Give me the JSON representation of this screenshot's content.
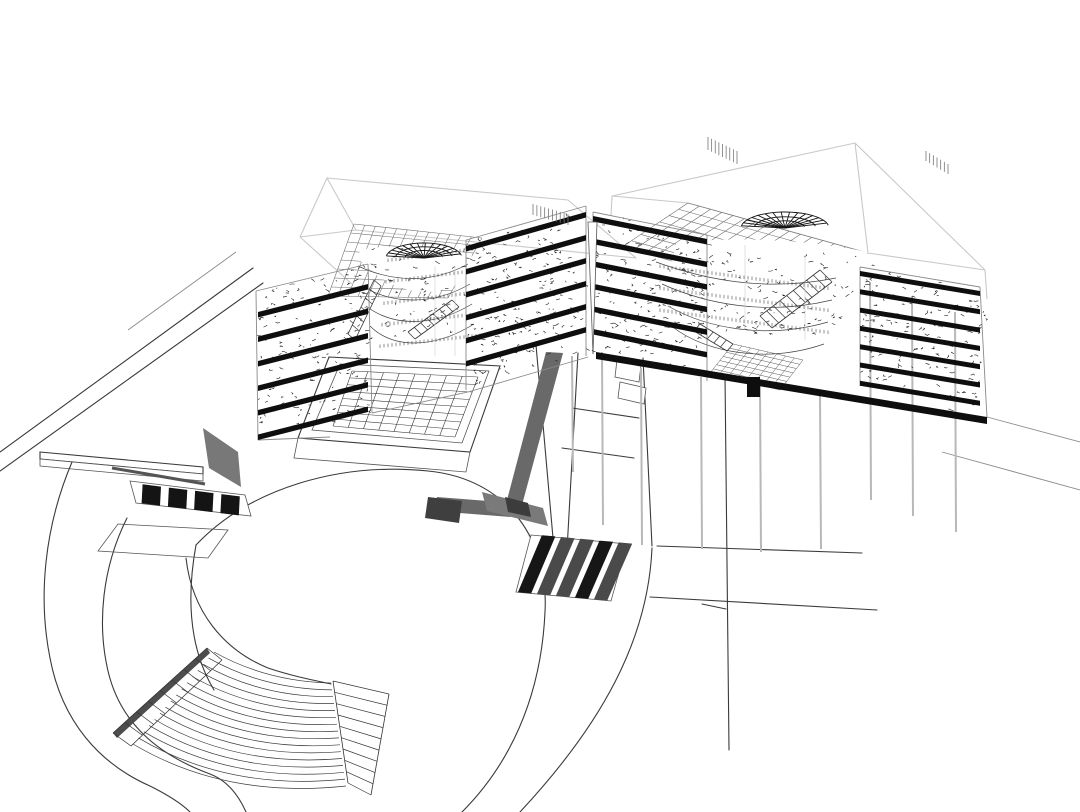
{
  "scene": {
    "type": "architectural-axonometric-section-drawing",
    "background": "#ffffff",
    "colors": {
      "line": "#3a3a3a",
      "thin_line": "#555555",
      "mid_line": "#8a8a8a",
      "light_line": "#c9c9c9",
      "detail_line": "#141414",
      "slab": "#0e0e0e",
      "shadow": "#696969",
      "dark_shadow": "#3f3f3f",
      "wedge_shadow": "#787878",
      "white": "#ffffff"
    },
    "buildings": {
      "left_wing": {
        "floor_slab_count": 6,
        "atrium_slab_count": 6,
        "dome_skylight": true,
        "roof_grid": true
      },
      "right_wing": {
        "atrium_slab_count": 6,
        "floor_slab_count": 7,
        "dome_skylight": true,
        "roof_grid": true,
        "ground_slab": true
      }
    },
    "site": {
      "courtyard_grid": {
        "cols": 8,
        "rows": 8
      },
      "ring_road_arc_count": 2,
      "amphitheater": {
        "step_arc_count": 16,
        "left_stair_tread_count": 8,
        "right_stair_tread_count": 9
      },
      "crosswalks": {
        "left_stripe_count": 4,
        "center_stripe_count": 5
      },
      "column_count": 9
    }
  }
}
